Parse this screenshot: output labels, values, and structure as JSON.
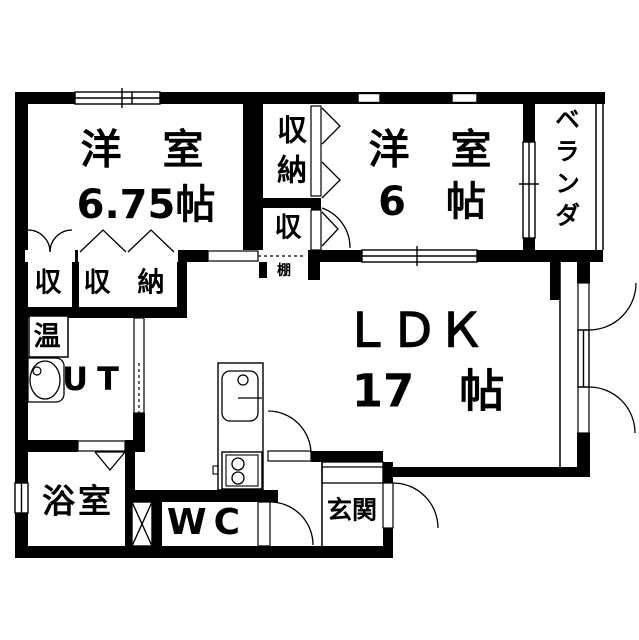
{
  "rooms": {
    "western_675": {
      "label": "洋　室",
      "size": "6.75帖"
    },
    "western_6": {
      "label": "洋　室",
      "size": "6　帖"
    },
    "ldk": {
      "label": "ＬＤＫ",
      "size": "17　帖"
    },
    "veranda": {
      "label": "ベランダ"
    },
    "bathroom": {
      "label": "浴室"
    },
    "toilet": {
      "label": "WC"
    },
    "entrance": {
      "label": "玄関"
    },
    "utility": {
      "label": "UT"
    }
  },
  "storage": {
    "closet_center": {
      "label": "収納"
    },
    "closet_center_small": {
      "label": "収"
    },
    "closet_left_small": {
      "label": "収"
    },
    "closet_left": {
      "label": "収　納"
    },
    "shelf": {
      "label": "棚"
    },
    "water_heater": {
      "label": "温"
    }
  },
  "colors": {
    "line": "#000000",
    "background": "#ffffff"
  }
}
